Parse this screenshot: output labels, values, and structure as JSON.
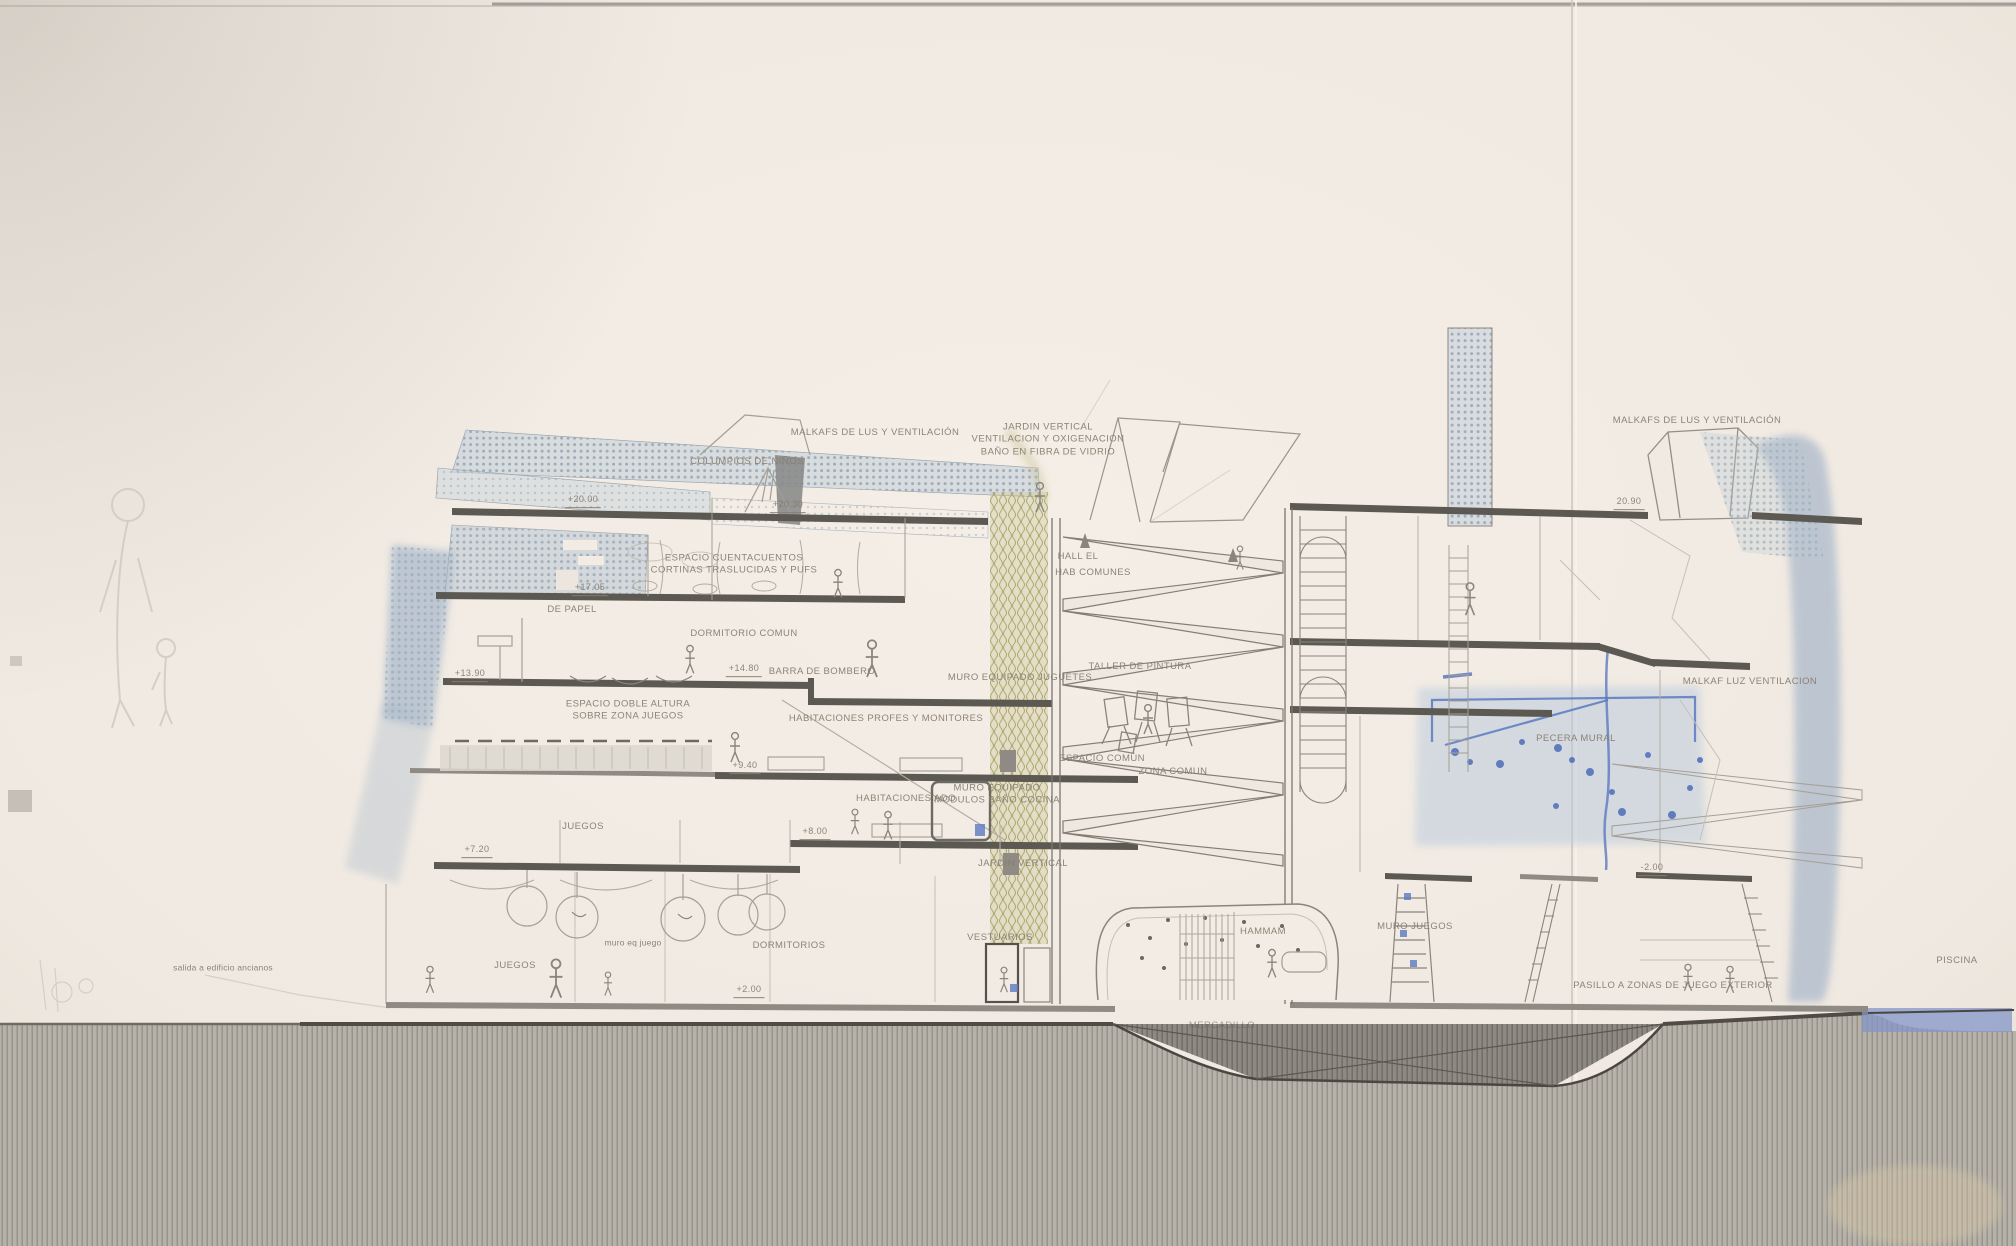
{
  "drawing": {
    "description_labels_note": "section drawing annotations",
    "palette": {
      "paper": "#f0eae2",
      "ink_text": "#877e70",
      "slab_dark": "#5c5952",
      "ground_hatch": "#b6b2aa",
      "ground_line": "#4f4c46",
      "hatch_blue": "#8ea3b6",
      "watercolor_blue": "#8aa2c0",
      "accent_blue": "#5b79c0",
      "olive_garden": "#a8a36e"
    },
    "labels": [
      {
        "name": "label-malkafs-izquierda",
        "text": "MALKAFS DE LUS Y VENTILACIÓN",
        "x": 875,
        "y": 433
      },
      {
        "name": "label-columpios",
        "text": "COLUMPIOS DE NIÑOS",
        "x": 747,
        "y": 462
      },
      {
        "name": "label-jardin-vertical-superior",
        "text": "JARDIN VERTICAL\nVENTILACION Y OXIGENACION\nBAÑO EN FIBRA DE VIDRIO",
        "x": 1048,
        "y": 440
      },
      {
        "name": "label-malkafs-derecha",
        "text": "MALKAFS DE LUS Y VENTILACIÓN",
        "x": 1697,
        "y": 421
      },
      {
        "name": "elevation-20-00",
        "text": "+20.00",
        "x": 583,
        "y": 501,
        "cls": "elev"
      },
      {
        "name": "elevation-20-30",
        "text": "+20.30",
        "x": 788,
        "y": 506,
        "cls": "elev"
      },
      {
        "name": "label-espacio-cuentacuentos",
        "text": "ESPACIO CUENTACUENTOS\nCORTINAS TRASLUCIDAS Y PUFS",
        "x": 734,
        "y": 565
      },
      {
        "name": "elevation-17-05",
        "text": "+17.05",
        "x": 590,
        "y": 589,
        "cls": "elev"
      },
      {
        "name": "label-de-papel",
        "text": "DE PAPEL",
        "x": 572,
        "y": 610
      },
      {
        "name": "label-dormitorio-comun",
        "text": "DORMITORIO COMUN",
        "x": 744,
        "y": 634
      },
      {
        "name": "elevation-13-90",
        "text": "+13.90",
        "x": 470,
        "y": 675,
        "cls": "elev"
      },
      {
        "name": "elevation-14-80",
        "text": "+14.80",
        "x": 744,
        "y": 670,
        "cls": "elev"
      },
      {
        "name": "label-barra-de-bombero",
        "text": "BARRA DE BOMBERO",
        "x": 822,
        "y": 672
      },
      {
        "name": "label-espacio-doble-altura",
        "text": "ESPACIO DOBLE ALTURA\nSOBRE ZONA JUEGOS",
        "x": 628,
        "y": 711
      },
      {
        "name": "label-habitaciones-profes",
        "text": "HABITACIONES PROFES Y MONITORES",
        "x": 886,
        "y": 719
      },
      {
        "name": "elevation-9-40",
        "text": "+9.40",
        "x": 745,
        "y": 767,
        "cls": "elev"
      },
      {
        "name": "label-muro-equipado-juguetes",
        "text": "MURO EQUIPADO JUGUETES",
        "x": 1020,
        "y": 678
      },
      {
        "name": "label-taller-de-pintura",
        "text": "TALLER DE PINTURA",
        "x": 1140,
        "y": 667
      },
      {
        "name": "label-hall",
        "text": "HALL EL",
        "x": 1078,
        "y": 557
      },
      {
        "name": "label-hab-comunes",
        "text": "HAB COMUNES",
        "x": 1093,
        "y": 573
      },
      {
        "name": "label-espacio-comun",
        "text": "ESPACIO COMÚN",
        "x": 1102,
        "y": 759
      },
      {
        "name": "label-zona-comun",
        "text": "ZONA COMUN",
        "x": 1173,
        "y": 772
      },
      {
        "name": "label-habitaciones-ado",
        "text": "HABITACIONES ADO",
        "x": 906,
        "y": 799
      },
      {
        "name": "label-muro-equipado-modulos",
        "text": "MURO EQUIPADO\nMODULOS BAÑO COCINA",
        "x": 997,
        "y": 795
      },
      {
        "name": "elevation-8-00",
        "text": "+8.00",
        "x": 815,
        "y": 833,
        "cls": "elev"
      },
      {
        "name": "label-jardin-vertical-inferior",
        "text": "JARDIN VERTICAL",
        "x": 1023,
        "y": 864
      },
      {
        "name": "elevation-7-20",
        "text": "+7.20",
        "x": 477,
        "y": 851,
        "cls": "elev"
      },
      {
        "name": "label-juegos-superior",
        "text": "JUEGOS",
        "x": 583,
        "y": 827
      },
      {
        "name": "label-juegos-inferior",
        "text": "JUEGOS",
        "x": 515,
        "y": 966
      },
      {
        "name": "label-muro-eq-juego",
        "text": "muro eq juego",
        "x": 633,
        "y": 943,
        "cls": "small"
      },
      {
        "name": "label-dormitorios",
        "text": "DORMITORIOS",
        "x": 789,
        "y": 946
      },
      {
        "name": "elevation-2-00",
        "text": "+2.00",
        "x": 749,
        "y": 991,
        "cls": "elev"
      },
      {
        "name": "label-vestuarios",
        "text": "VESTUARIOS",
        "x": 1000,
        "y": 938
      },
      {
        "name": "label-hammam",
        "text": "HAMMAM",
        "x": 1263,
        "y": 932
      },
      {
        "name": "label-mercadillo",
        "text": "MERCADILLO",
        "x": 1222,
        "y": 1026,
        "cls": "faint"
      },
      {
        "name": "label-muro-juegos",
        "text": "MURO JUEGOS",
        "x": 1415,
        "y": 927
      },
      {
        "name": "elevation-neg-2-00",
        "text": "-2.00",
        "x": 1652,
        "y": 869,
        "cls": "elev"
      },
      {
        "name": "label-pasillo-juego-exterior",
        "text": "PASILLO A ZONAS DE JUEGO EXTERIOR",
        "x": 1673,
        "y": 986
      },
      {
        "name": "label-pecera-mural",
        "text": "PECERA MURAL",
        "x": 1576,
        "y": 739
      },
      {
        "name": "label-malkaf-luz-ventilacion",
        "text": "MALKAF LUZ VENTILACION",
        "x": 1750,
        "y": 682
      },
      {
        "name": "elevation-20-90",
        "text": "20.90",
        "x": 1629,
        "y": 503,
        "cls": "elev"
      },
      {
        "name": "label-piscina",
        "text": "PISCINA",
        "x": 1957,
        "y": 961
      },
      {
        "name": "label-salida-ancianos",
        "text": "salida a edificio ancianos",
        "x": 223,
        "y": 968,
        "cls": "small"
      }
    ]
  }
}
